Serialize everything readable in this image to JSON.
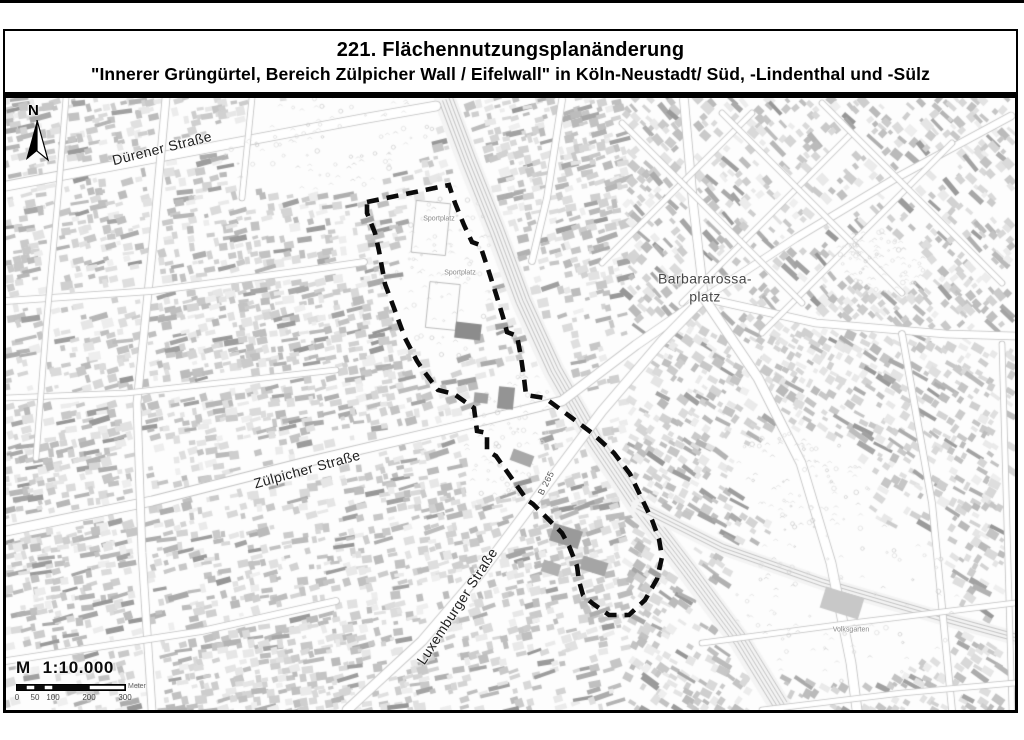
{
  "title": {
    "line1": "221. Flächennutzungsplanänderung",
    "line2": "\"Innerer Grüngürtel, Bereich Zülpicher Wall / Eifelwall\" in Köln-Neustadt/ Süd, -Lindenthal und -Sülz"
  },
  "north": {
    "label": "N"
  },
  "labels": {
    "duerener": "Dürener Straße",
    "zuelpicher": "Zülpicher Straße",
    "luxemburger": "Luxemburger Straße",
    "barbarossa_line1": "Barbararossa-",
    "barbarossa_line2": "platz",
    "b265": "B 265",
    "volksgarten": "Volksgarten",
    "sportplatz_north": "Sportplatz",
    "sportplatz_south": "Sportplatz"
  },
  "scale": {
    "prefix": "M",
    "ratio": "1:10.000",
    "unit": "Meter",
    "ticks": [
      "0",
      "50",
      "100",
      "200",
      "300"
    ]
  },
  "colors": {
    "boundary": "#0b0b0b",
    "map_line": "#b4b4b4",
    "road_edge": "#c2c2c2",
    "paper": "#ffffff"
  },
  "plan_boundary": {
    "stroke_width": 4.6,
    "dash": [
      12,
      8
    ],
    "points": [
      [
        361,
        104
      ],
      [
        443,
        87
      ],
      [
        449,
        105
      ],
      [
        458,
        127
      ],
      [
        466,
        144
      ],
      [
        474,
        147
      ],
      [
        482,
        171
      ],
      [
        490,
        196
      ],
      [
        497,
        219
      ],
      [
        501,
        234
      ],
      [
        511,
        238
      ],
      [
        515,
        259
      ],
      [
        518,
        280
      ],
      [
        520,
        297
      ],
      [
        539,
        300
      ],
      [
        562,
        317
      ],
      [
        586,
        335
      ],
      [
        608,
        355
      ],
      [
        624,
        376
      ],
      [
        636,
        401
      ],
      [
        646,
        422
      ],
      [
        653,
        441
      ],
      [
        656,
        459
      ],
      [
        651,
        481
      ],
      [
        639,
        502
      ],
      [
        623,
        517
      ],
      [
        603,
        517
      ],
      [
        586,
        505
      ],
      [
        577,
        497
      ],
      [
        573,
        483
      ],
      [
        571,
        468
      ],
      [
        563,
        448
      ],
      [
        556,
        435
      ],
      [
        527,
        406
      ],
      [
        521,
        402
      ],
      [
        490,
        358
      ],
      [
        485,
        355
      ],
      [
        481,
        352
      ],
      [
        481,
        335
      ],
      [
        471,
        333
      ],
      [
        468,
        310
      ],
      [
        448,
        296
      ],
      [
        432,
        292
      ],
      [
        417,
        272
      ],
      [
        411,
        263
      ],
      [
        399,
        240
      ],
      [
        388,
        210
      ],
      [
        379,
        186
      ],
      [
        373,
        153
      ],
      [
        369,
        135
      ],
      [
        361,
        115
      ]
    ]
  },
  "map_features": {
    "roads": [
      {
        "w": 9,
        "pts": [
          [
            0,
            88
          ],
          [
            196,
            51
          ],
          [
            356,
            21
          ],
          [
            430,
            8
          ]
        ]
      },
      {
        "w": 9,
        "pts": [
          [
            0,
            433
          ],
          [
            146,
            403
          ],
          [
            296,
            365
          ],
          [
            446,
            330
          ],
          [
            556,
            303
          ],
          [
            630,
            247
          ],
          [
            698,
            200
          ]
        ]
      },
      {
        "w": 9,
        "pts": [
          [
            341,
            612
          ],
          [
            416,
            543
          ],
          [
            476,
            473
          ],
          [
            536,
            393
          ],
          [
            596,
            313
          ],
          [
            656,
            243
          ],
          [
            698,
            200
          ]
        ]
      },
      {
        "w": 8,
        "pts": [
          [
            698,
            200
          ],
          [
            687,
            105
          ],
          [
            678,
            2
          ]
        ]
      },
      {
        "w": 7,
        "pts": [
          [
            698,
            200
          ],
          [
            790,
            140
          ],
          [
            890,
            80
          ],
          [
            1005,
            18
          ]
        ]
      },
      {
        "w": 7,
        "pts": [
          [
            698,
            200
          ],
          [
            810,
            225
          ],
          [
            940,
            236
          ],
          [
            1009,
            238
          ]
        ]
      },
      {
        "w": 9,
        "pts": [
          [
            698,
            200
          ],
          [
            752,
            280
          ],
          [
            795,
            365
          ],
          [
            825,
            465
          ],
          [
            845,
            565
          ],
          [
            851,
            612
          ]
        ]
      },
      {
        "w": 7,
        "pts": [
          [
            160,
            0
          ],
          [
            146,
            155
          ],
          [
            131,
            305
          ],
          [
            136,
            455
          ],
          [
            146,
            612
          ]
        ]
      },
      {
        "w": 6,
        "pts": [
          [
            0,
            203
          ],
          [
            146,
            193
          ],
          [
            296,
            173
          ],
          [
            358,
            164
          ]
        ]
      },
      {
        "w": 6,
        "pts": [
          [
            0,
            563
          ],
          [
            196,
            533
          ],
          [
            330,
            503
          ]
        ]
      },
      {
        "w": 5,
        "pts": [
          [
            246,
            0
          ],
          [
            236,
            100
          ]
        ]
      },
      {
        "w": 6,
        "pts": [
          [
            556,
            2
          ],
          [
            541,
            100
          ],
          [
            526,
            163
          ]
        ]
      },
      {
        "w": 5,
        "pts": [
          [
            596,
            165
          ],
          [
            746,
            15
          ]
        ]
      },
      {
        "w": 5,
        "pts": [
          [
            676,
            205
          ],
          [
            846,
            35
          ]
        ]
      },
      {
        "w": 5,
        "pts": [
          [
            756,
            235
          ],
          [
            946,
            45
          ]
        ]
      },
      {
        "w": 5,
        "pts": [
          [
            616,
            25
          ],
          [
            796,
            205
          ]
        ]
      },
      {
        "w": 5,
        "pts": [
          [
            716,
            15
          ],
          [
            896,
            195
          ]
        ]
      },
      {
        "w": 5,
        "pts": [
          [
            816,
            5
          ],
          [
            996,
            185
          ]
        ]
      },
      {
        "w": 6,
        "pts": [
          [
            896,
            236
          ],
          [
            926,
            405
          ],
          [
            946,
            612
          ]
        ]
      },
      {
        "w": 5,
        "pts": [
          [
            996,
            246
          ],
          [
            1006,
            612
          ]
        ]
      },
      {
        "w": 5,
        "pts": [
          [
            696,
            545
          ],
          [
            846,
            525
          ],
          [
            1009,
            505
          ]
        ]
      },
      {
        "w": 5,
        "pts": [
          [
            756,
            612
          ],
          [
            896,
            595
          ],
          [
            1009,
            585
          ]
        ]
      },
      {
        "w": 5,
        "pts": [
          [
            0,
            300
          ],
          [
            120,
            295
          ],
          [
            240,
            282
          ],
          [
            330,
            272
          ]
        ]
      },
      {
        "w": 5,
        "pts": [
          [
            60,
            0
          ],
          [
            52,
            100
          ],
          [
            40,
            230
          ],
          [
            30,
            360
          ]
        ]
      }
    ],
    "railways": [
      {
        "band": 22,
        "pts": [
          [
            439,
            2
          ],
          [
            462,
            63
          ],
          [
            490,
            133
          ],
          [
            516,
            203
          ],
          [
            548,
            273
          ],
          [
            588,
            343
          ],
          [
            632,
            408
          ],
          [
            682,
            473
          ],
          [
            734,
            543
          ],
          [
            774,
            608
          ]
        ]
      },
      {
        "band": 14,
        "pts": [
          [
            632,
            408
          ],
          [
            716,
            450
          ],
          [
            816,
            485
          ],
          [
            936,
            520
          ],
          [
            1009,
            540
          ]
        ]
      }
    ],
    "parks": [
      {
        "cx": 326,
        "cy": 43,
        "rx": 108,
        "ry": 50,
        "rot": -0.15
      },
      {
        "cx": 439,
        "cy": 175,
        "rx": 50,
        "ry": 92,
        "rot": 0.08
      },
      {
        "cx": 501,
        "cy": 333,
        "rx": 40,
        "ry": 70,
        "rot": 0.32
      },
      {
        "cx": 836,
        "cy": 503,
        "rx": 118,
        "ry": 84,
        "rot": 0
      },
      {
        "cx": 796,
        "cy": 383,
        "rx": 72,
        "ry": 48,
        "rot": 0.2
      },
      {
        "cx": 876,
        "cy": 163,
        "rx": 46,
        "ry": 30,
        "rot": 0.3
      }
    ],
    "landmarks": [
      {
        "x": 425,
        "y": 130,
        "w": 34,
        "h": 52,
        "rot": 0.1,
        "stroke": "#b0b0b0"
      },
      {
        "x": 437,
        "y": 208,
        "w": 30,
        "h": 46,
        "rot": 0.1,
        "stroke": "#b0b0b0"
      },
      {
        "x": 462,
        "y": 233,
        "w": 26,
        "h": 16,
        "rot": 0.12,
        "fill": "#8c8c8c"
      },
      {
        "x": 500,
        "y": 300,
        "w": 16,
        "h": 22,
        "rot": 0.1,
        "fill": "#949494"
      },
      {
        "x": 475,
        "y": 300,
        "w": 14,
        "h": 10,
        "rot": 0.1,
        "fill": "#a0a0a0"
      },
      {
        "x": 516,
        "y": 360,
        "w": 22,
        "h": 12,
        "rot": 0.35,
        "fill": "#a8a8a8"
      },
      {
        "x": 560,
        "y": 438,
        "w": 30,
        "h": 18,
        "rot": 0.3,
        "fill": "#9a9a9a"
      },
      {
        "x": 588,
        "y": 468,
        "w": 26,
        "h": 14,
        "rot": 0.3,
        "fill": "#a5a5a5"
      },
      {
        "x": 545,
        "y": 470,
        "w": 18,
        "h": 12,
        "rot": 0.3,
        "fill": "#b0b0b0"
      },
      {
        "x": 836,
        "y": 505,
        "w": 40,
        "h": 22,
        "rot": 0.3,
        "fill": "#c8c8c8"
      }
    ]
  }
}
